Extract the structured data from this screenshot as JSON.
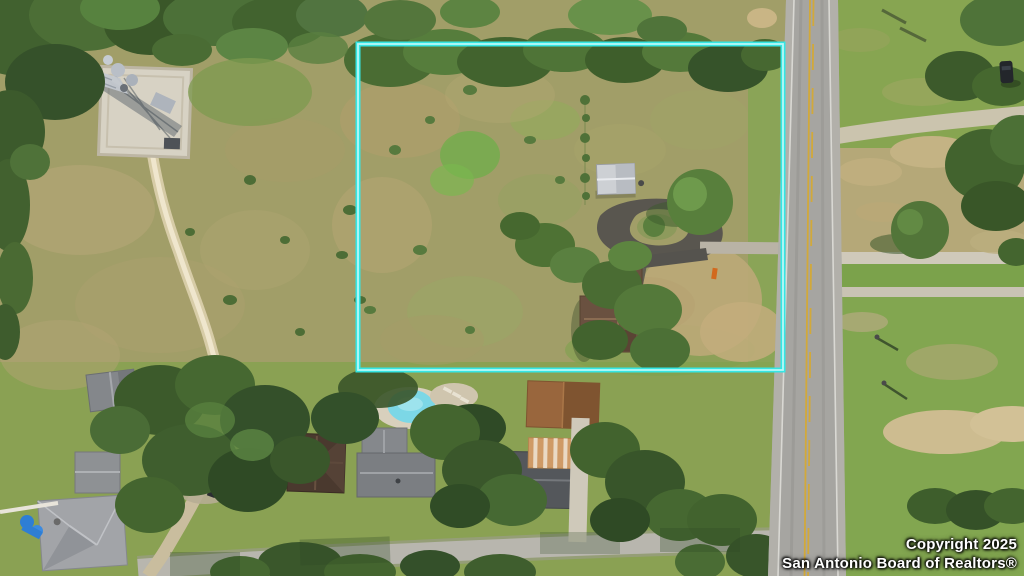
{
  "scene": {
    "description": "Aerial drone photograph of a rural lot outlined in cyan beside a two-lane road, with a lattice tower on a gravel pad, a winding dirt trail, a house with circular driveway inside the boundary, and neighboring homes with a swimming pool along a street at the bottom"
  },
  "boundary": {
    "stroke_color": "#35e6e4",
    "core_color": "#ccfbfa"
  },
  "pool": {
    "water_color": "#7cd7e6"
  },
  "road": {
    "center_line_color": "#d2a93a"
  },
  "watermark": {
    "line1": "Copyright 2025",
    "line2": "San Antonio Board of Realtors®"
  }
}
